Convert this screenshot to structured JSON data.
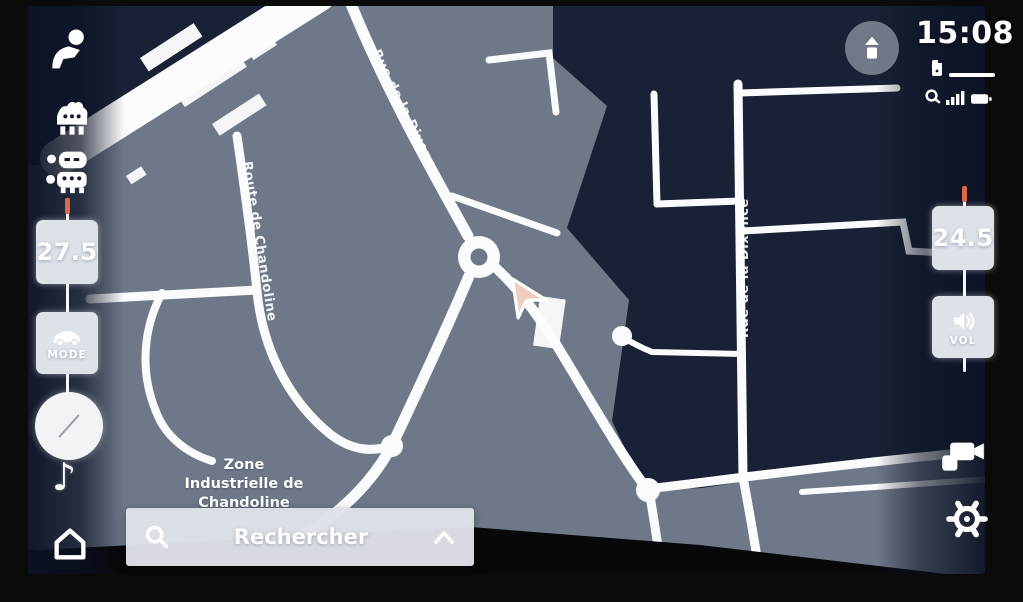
{
  "status": {
    "time": "15:08"
  },
  "climate": {
    "driver_temp": "27.5",
    "passenger_temp": "24.5",
    "mode_label": "MODE",
    "volume_label": "VOL"
  },
  "search": {
    "placeholder": "Rechercher"
  },
  "map": {
    "zone_line1": "Zone",
    "zone_line2": "Industrielle de",
    "zone_line3": "Chandoline",
    "road_top": "Rue de la Dixence",
    "road_left": "Route de Chandoline",
    "road_right": "Rue de la Dixence"
  },
  "glyphs": {
    "music_note": "♪"
  },
  "colors": {
    "map_base": "#6e7888",
    "district_dark": "#1a2136",
    "road_white": "#fafbfc",
    "slider_accent": "#d96a4a",
    "button_bg": "#dde2e8",
    "text_white": "#ffffff"
  }
}
